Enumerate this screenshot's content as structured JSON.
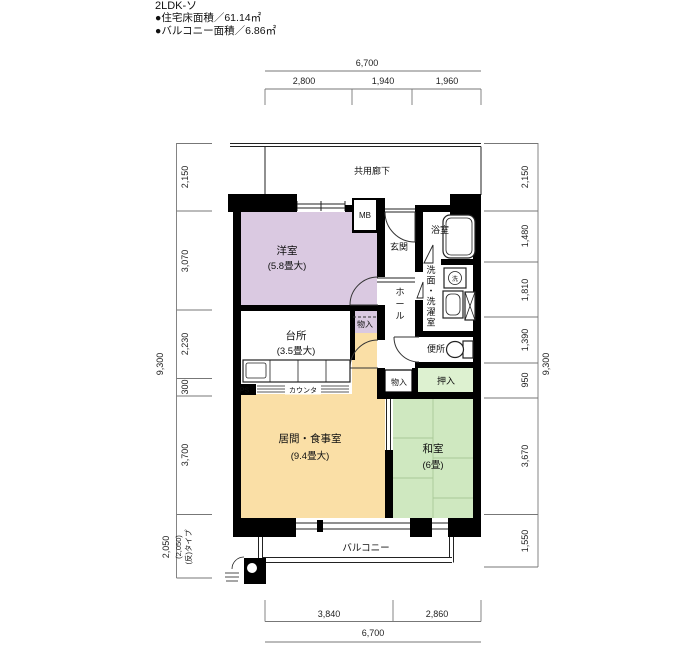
{
  "header": {
    "title": "2LDK-ソ",
    "area_line1": "●住宅床面積／61.14㎡",
    "area_line2": "●バルコニー面積／6.86㎡"
  },
  "labels": {
    "corridor": "共用廊下",
    "mb": "MB",
    "genkan": "玄関",
    "bath": "浴室",
    "western_room": "洋室",
    "western_room_size": "(5.8畳大)",
    "washroom": "洗面・洗濯室",
    "hall": "ホール",
    "washer_mark": "洗",
    "toilet": "便所",
    "storage": "物入",
    "closet": "押入",
    "kitchen": "台所",
    "kitchen_size": "(3.5畳大)",
    "counter": "カウンタ",
    "ps": "PS",
    "living": "居間・食事室",
    "living_size": "(9.4畳大)",
    "japanese_room": "和室",
    "japanese_room_size": "(6畳)",
    "balcony": "バルコニー"
  },
  "dimensions": {
    "top": {
      "total": "6,700",
      "segments": [
        "2,800",
        "1,940",
        "1,960"
      ]
    },
    "bottom": {
      "total": "6,700",
      "segments": [
        "3,840",
        "2,860"
      ]
    },
    "left": {
      "overall": "9,300",
      "segments": [
        "2,150",
        "3,070",
        "2,230",
        "300",
        "3,700",
        "2,050"
      ],
      "alt": "(2,050)",
      "alt_note": "(反)タイプ"
    },
    "right": {
      "overall": "9,300",
      "segments": [
        "2,150",
        "1,480",
        "1,810",
        "1,390",
        "950",
        "3,670",
        "1,550"
      ]
    }
  },
  "colors": {
    "wall": "#000000",
    "western_room": "#dac9e1",
    "living": "#fadfa6",
    "japanese_room": "#cfe8c0",
    "closet": "#ddf1d0",
    "tatami_line": "#a9c897"
  }
}
